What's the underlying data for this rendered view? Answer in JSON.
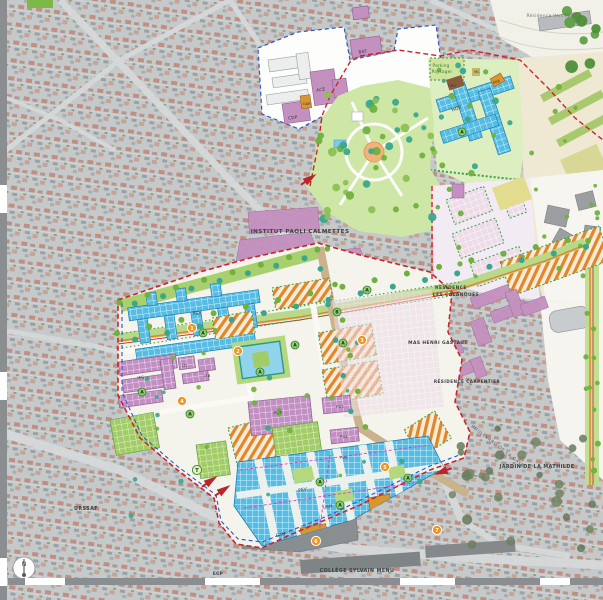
{
  "map": {
    "colors": {
      "site_boundary_red": "#c8242a",
      "secondary_boundary_blue": "#2a52cc",
      "planned_cyan": "#55bde4",
      "planned_purple": "#c18fc2",
      "existing_mauve": "#c490bf",
      "hatch_orange": "#e0872c",
      "park_green": "#cfe7a6",
      "tree_green": "#6fb13c",
      "tree_teal": "#3aa68d",
      "lawn_green": "#a2cc66",
      "marker_orange": "#f0941f",
      "marker_green_fill": "#8fd06a",
      "arrow_red": "#b8252a",
      "aerial_gray": "#c5c9ca"
    },
    "labels": [
      {
        "id": "institut-paoli-calmettes",
        "cls": "area",
        "text": "INSTITUT PAOLI CALMETTES",
        "x": 300,
        "y": 233,
        "size": 5.6
      },
      {
        "id": "residence-vert-parc",
        "cls": "soft",
        "text": "Résidence Vert Parc",
        "x": 551,
        "y": 17,
        "size": 4.4
      },
      {
        "id": "residence-les-calanques-1",
        "cls": "area",
        "text": "RÉSIDENCE",
        "x": 451,
        "y": 289,
        "size": 4.4
      },
      {
        "id": "residence-les-calanques-2",
        "cls": "area",
        "text": "LES CALANQUES",
        "x": 456,
        "y": 296,
        "size": 4.4
      },
      {
        "id": "mas-henri-gastaut",
        "cls": "area",
        "text": "MAS HENRI GASTAUT",
        "x": 438,
        "y": 344,
        "size": 4.4
      },
      {
        "id": "residence-carpentier",
        "cls": "area",
        "text": "RÉSIDENCE CARPENTIER",
        "x": 467,
        "y": 383,
        "size": 4.2
      },
      {
        "id": "jardin-de-la-mathilde",
        "cls": "area",
        "text": "JARDIN DE LA MATHILDE",
        "x": 537,
        "y": 468,
        "size": 4.8
      },
      {
        "id": "college-sylvain-menu",
        "cls": "area",
        "text": "COLLÈGE SYLVAIN MENU",
        "x": 357,
        "y": 572,
        "size": 4.8
      },
      {
        "id": "urssaf",
        "cls": "area",
        "text": "URSSAF",
        "x": 86,
        "y": 510,
        "size": 4.8
      },
      {
        "id": "ecp",
        "cls": "area",
        "text": "ECP",
        "x": 218,
        "y": 575,
        "size": 4.2
      },
      {
        "id": "parking-paysager-1",
        "cls": "green",
        "text": "Parking",
        "x": 441,
        "y": 67,
        "size": 4.2
      },
      {
        "id": "parking-paysager-2",
        "cls": "green",
        "text": "Paysager",
        "x": 442,
        "y": 73,
        "size": 4.2
      },
      {
        "id": "boulevard-de-la-gaye",
        "cls": "street",
        "text": "BOULEVARD DE LA GAYE",
        "x": 497,
        "y": 447,
        "size": 4.2,
        "rot": 38
      },
      {
        "id": "bldg-psy",
        "cls": "bldg",
        "text": "PSY",
        "x": 197,
        "y": 315,
        "size": 4.6
      },
      {
        "id": "bldg-pev",
        "cls": "bldg",
        "text": "PEV",
        "x": 303,
        "y": 491,
        "size": 4.3,
        "rot": -12
      },
      {
        "id": "bldg-usn",
        "cls": "bldg",
        "text": "USN",
        "x": 328,
        "y": 508,
        "size": 4.3,
        "rot": -12
      },
      {
        "id": "bldg-can",
        "cls": "bldg",
        "text": "CAN",
        "x": 281,
        "y": 536,
        "size": 4.3,
        "rot": -10
      },
      {
        "id": "bldg-pcp",
        "cls": "bldg",
        "text": "PCP",
        "x": 278,
        "y": 414,
        "size": 4.3,
        "rot": -6
      },
      {
        "id": "bldg-p03",
        "cls": "bldg",
        "text": "P03",
        "x": 340,
        "y": 408,
        "size": 3.8
      },
      {
        "id": "bldg-p04",
        "cls": "bldg",
        "text": "P04",
        "x": 344,
        "y": 438,
        "size": 3.8
      },
      {
        "id": "bldg-p05",
        "cls": "bldg",
        "text": "P05",
        "x": 344,
        "y": 459,
        "size": 3.8
      },
      {
        "id": "bldg-ifs",
        "cls": "bldg",
        "text": "IFS",
        "x": 141,
        "y": 379,
        "size": 4.2,
        "rot": -8
      },
      {
        "id": "bldg-ltl",
        "cls": "bldg",
        "text": "LTL",
        "x": 185,
        "y": 367,
        "size": 3.8
      },
      {
        "id": "bldg-ltb",
        "cls": "bldg",
        "text": "LTB",
        "x": 207,
        "y": 377,
        "size": 3.8
      },
      {
        "id": "bldg-hop",
        "cls": "bldg",
        "text": "HOP",
        "x": 457,
        "y": 110,
        "size": 4.6,
        "rot": -18
      },
      {
        "id": "bldg-ace",
        "cls": "bldg",
        "text": "ACE",
        "x": 321,
        "y": 91,
        "size": 4.2,
        "rot": -8
      },
      {
        "id": "bldg-cdp",
        "cls": "bldg",
        "text": "CDP",
        "x": 293,
        "y": 119,
        "size": 4.2,
        "rot": -8
      },
      {
        "id": "bldg-bat",
        "cls": "bldg",
        "text": "BAT",
        "x": 363,
        "y": 53,
        "size": 4.2,
        "rot": -8
      },
      {
        "id": "bldg-gar",
        "cls": "bldg",
        "text": "GAR",
        "x": 307,
        "y": 105,
        "size": 3.4
      },
      {
        "id": "bldg-chv",
        "cls": "bldg",
        "text": "CHV",
        "x": 452,
        "y": 87,
        "size": 3.4
      },
      {
        "id": "bldg-mc",
        "cls": "bldg",
        "text": "MC",
        "x": 477,
        "y": 73,
        "size": 3.4
      },
      {
        "id": "bldg-prb",
        "cls": "bldg",
        "text": "PRB",
        "x": 497,
        "y": 83,
        "size": 3.4,
        "rot": -20
      }
    ],
    "markers": {
      "numbered": [
        {
          "n": "1",
          "x": 192,
          "y": 328
        },
        {
          "n": "2",
          "x": 238,
          "y": 351
        },
        {
          "n": "3",
          "x": 362,
          "y": 340
        },
        {
          "n": "4",
          "x": 182,
          "y": 401
        },
        {
          "n": "5",
          "x": 385,
          "y": 467
        },
        {
          "n": "6",
          "x": 316,
          "y": 541
        },
        {
          "n": "7",
          "x": 437,
          "y": 530
        }
      ],
      "lettered": [
        {
          "l": "A",
          "x": 203,
          "y": 333
        },
        {
          "l": "A",
          "x": 295,
          "y": 345
        },
        {
          "l": "A",
          "x": 343,
          "y": 343
        },
        {
          "l": "A",
          "x": 367,
          "y": 290
        },
        {
          "l": "B",
          "x": 337,
          "y": 312
        },
        {
          "l": "A",
          "x": 142,
          "y": 392
        },
        {
          "l": "A",
          "x": 190,
          "y": 414
        },
        {
          "l": "A",
          "x": 260,
          "y": 372
        },
        {
          "l": "A",
          "x": 320,
          "y": 482
        },
        {
          "l": "A",
          "x": 340,
          "y": 505
        },
        {
          "l": "A",
          "x": 408,
          "y": 478
        },
        {
          "l": "A",
          "x": 462,
          "y": 132
        }
      ],
      "tram": {
        "l": "T",
        "x": 197,
        "y": 470
      }
    },
    "compass": {
      "label": "N"
    }
  }
}
